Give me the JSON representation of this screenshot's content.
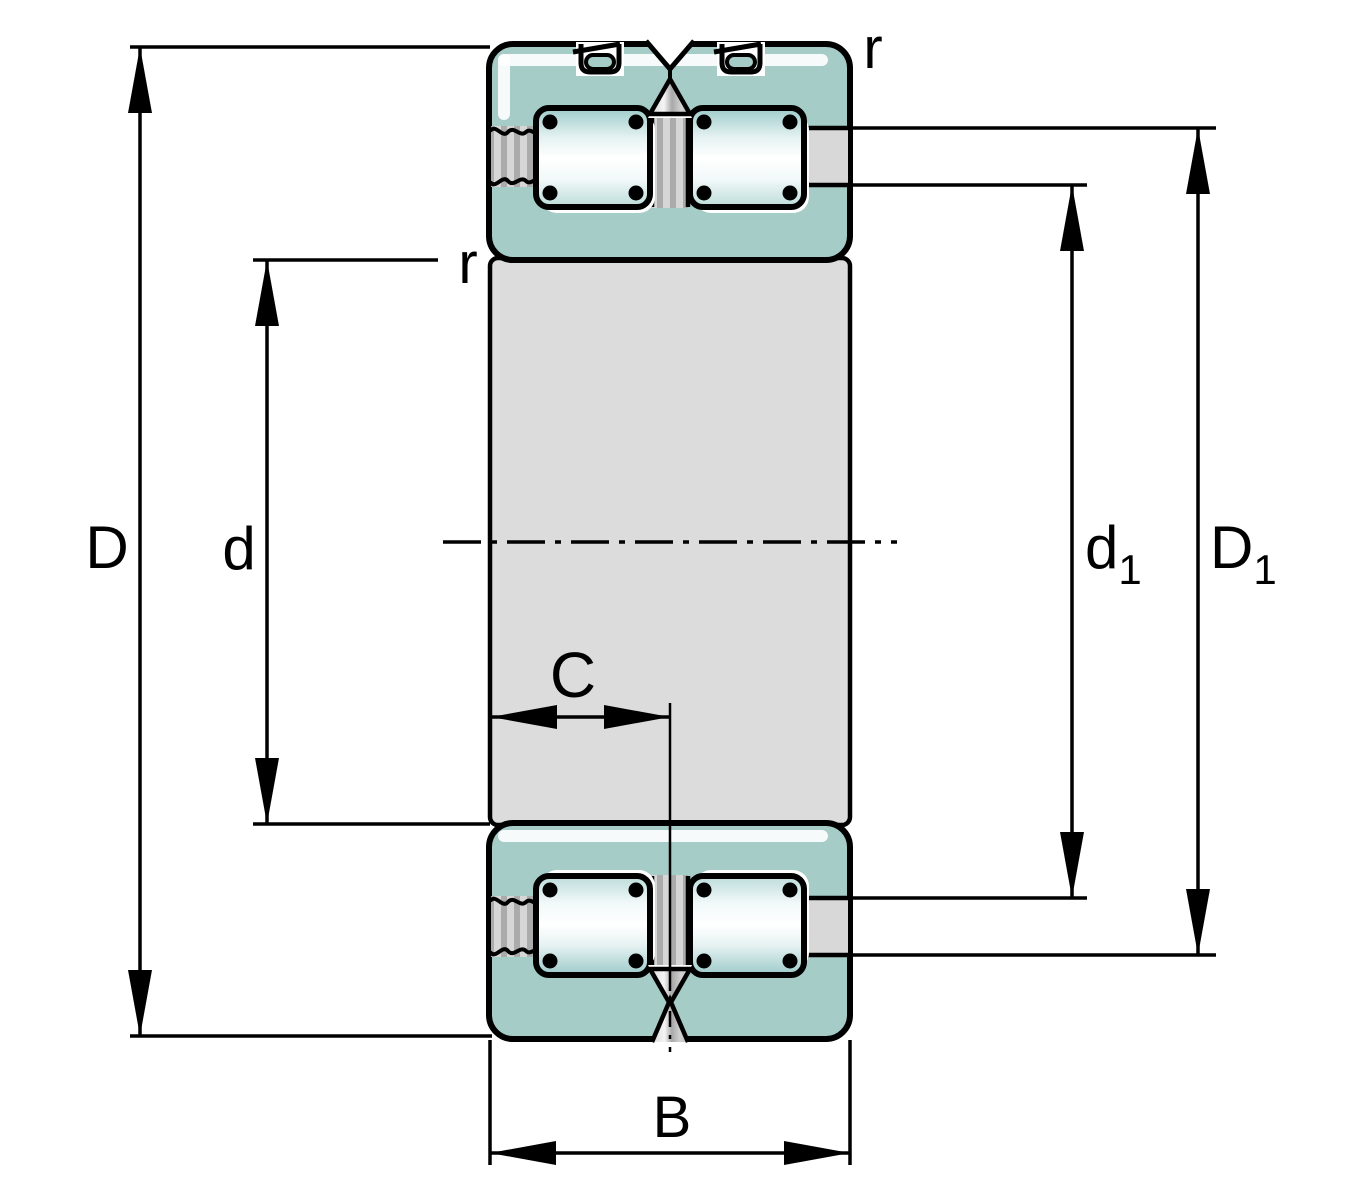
{
  "labels": {
    "outside_diameter": "D",
    "bore_diameter": "d",
    "shoulder_inner": {
      "base": "d",
      "sub": "1"
    },
    "shoulder_outer": {
      "base": "D",
      "sub": "1"
    },
    "total_width": "B",
    "row_width": "C",
    "chamfer_outer": "r",
    "chamfer_inner": "r"
  },
  "colors": {
    "ring": "#a6ccc8",
    "bore": "#dcdcdc",
    "band": "#d8d8d8",
    "stripe_light": "#d6d6d6",
    "stripe_dark": "#ababab",
    "roller_teal": "#9dcaca",
    "roller_highlight": "#ffffff",
    "outline": "#000000"
  }
}
